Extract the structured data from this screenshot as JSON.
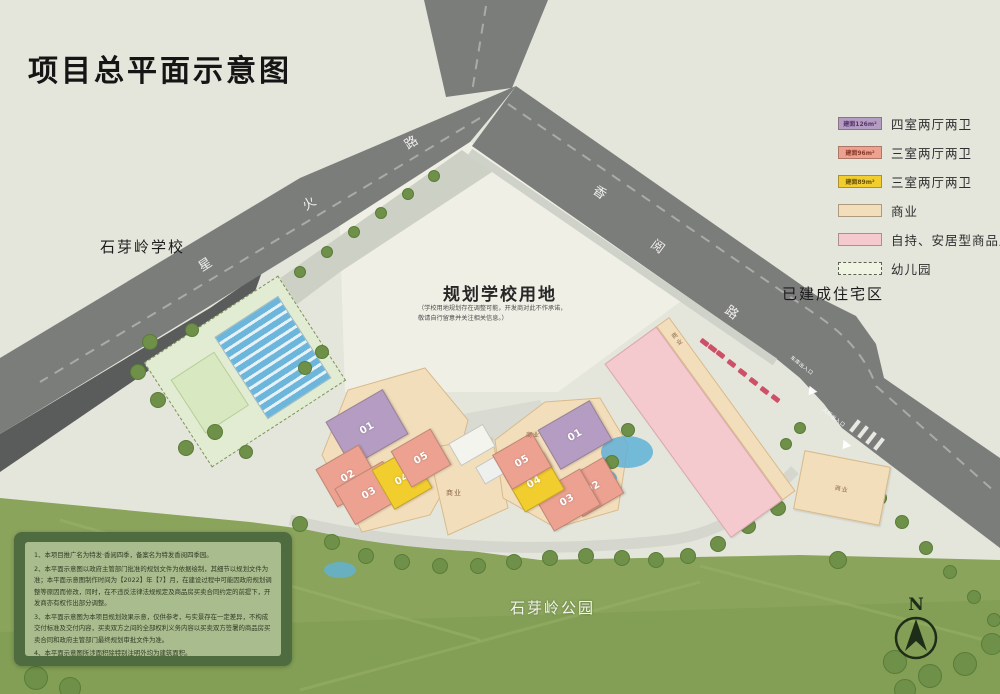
{
  "title": "项目总平面示意图",
  "colors": {
    "bg": "#e4e6dc",
    "school": "#efefe6",
    "road": "#7b7d7b",
    "park": "#8aa45c",
    "purple": "#b59cc3",
    "salmon": "#eda291",
    "yellow": "#f2cd2e",
    "commercial": "#f3debc",
    "pink": "#f5cacf",
    "kindergarten": "#e2ecd2"
  },
  "legend": {
    "items": [
      {
        "area": "建面126m²",
        "label": "四室两厅两卫",
        "color": "#b59cc3",
        "text_color": "#53386a"
      },
      {
        "area": "建面96m²",
        "label": "三室两厅两卫",
        "color": "#eda291",
        "text_color": "#8a3a28"
      },
      {
        "area": "建面89m²",
        "label": "三室两厅两卫",
        "color": "#f2cd2e",
        "text_color": "#6a5208"
      },
      {
        "area": "",
        "label": "商业",
        "color": "#f3debc",
        "text_color": "#8a6848"
      },
      {
        "area": "",
        "label": "自持、安居型商品房",
        "color": "#f5cacf",
        "text_color": "#8a5a60"
      },
      {
        "area": "",
        "label": "幼儿园",
        "color": "#f0f4e2",
        "text_color": "#5a6152"
      }
    ]
  },
  "map": {
    "school_left": "石芽岭学校",
    "planned_school": "规划学校用地",
    "planned_school_note": "（学校用地规划存在调整可能，开发商对此不作承诺，敬请自行留意并关注相关信息。）",
    "built_residential": "已建成住宅区",
    "park": "石芽岭公园",
    "compass": "N",
    "commercial_label": "商业",
    "roads": {
      "xinghuo": [
        "星",
        "火",
        "路"
      ],
      "xiangyue": [
        "香",
        "阅",
        "路"
      ]
    },
    "entrances": {
      "garage": "车库出入口",
      "pedestrian": "人行出入口"
    }
  },
  "buildings": {
    "left": [
      {
        "label": "01"
      },
      {
        "label": "02"
      },
      {
        "label": "03"
      },
      {
        "label": "04"
      },
      {
        "label": "05"
      }
    ],
    "right": [
      {
        "label": "01"
      },
      {
        "label": "02"
      },
      {
        "label": "03"
      },
      {
        "label": "04"
      },
      {
        "label": "05"
      }
    ]
  },
  "notes": {
    "lines": [
      "1、本项目推广名为特发·香阅四季，备案名为特发香阅四季园。",
      "2、本平面示意图以政府主管部门批准的规划文件为依据绘制，其细节以规划文件为准；本平面示意图制作时间为【2022】年【7】月，在建设过程中可能因政府规划调整等原因而修改，同时，在不违反法律法规规定及商品房买卖合同约定的前提下，开发商亦有权作出部分调整。",
      "3、本平面示意图为本项目规划效果示意，仅供参考，与实景存在一定差异，不构成交付标准及交付内容，买卖双方之间的全部权利义务内容以买卖双方签署的商品房买卖合同和政府主管部门最终规划审批文件为准。",
      "4、本平面示意图所涉面积除特别注明外均为建筑面积。"
    ]
  }
}
